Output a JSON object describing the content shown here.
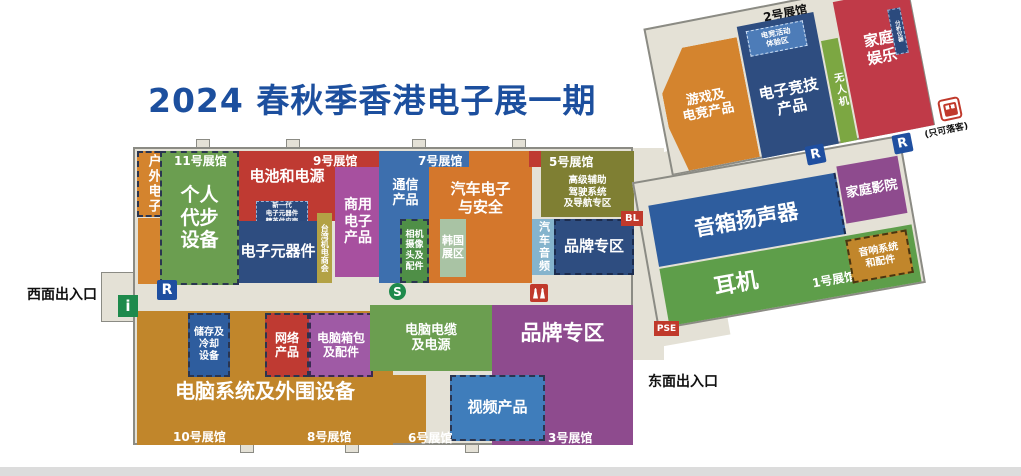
{
  "title": "2024 春秋季香港电子展一期",
  "colors": {
    "title_blue": "#1c4f9e",
    "floor_beige": "#e4e1d6",
    "orange": "#d4842e",
    "tan": "#c1862b",
    "red": "#bf3a32",
    "crimson": "#c03a48",
    "green": "#6b9e50",
    "dark_green": "#4f8f47",
    "sage": "#a9c3a4",
    "navy": "#2e4d80",
    "blue": "#3d6fae",
    "light_blue": "#85b4cd",
    "steel_blue": "#3f7dbb",
    "magenta": "#a7509f",
    "purple": "#8e4b8e",
    "olive": "#7f7f33",
    "gold": "#b3a245",
    "icon_green": "#1e8a4c",
    "icon_blue": "#1f4fa0",
    "icon_red": "#c0392b"
  },
  "entrances": {
    "west": "西面出入口",
    "east": "东面出入口",
    "dropoff": "(只可落客)"
  },
  "hall_labels": {
    "h11": "11号展馆",
    "h9": "9号展馆",
    "h7": "7号展馆",
    "h5": "5号展馆",
    "h2": "2号展馆",
    "h10": "10号展馆",
    "h8": "8号展馆",
    "h6": "6号展馆",
    "h3": "3号展馆",
    "h1": "1号展馆"
  },
  "zones": {
    "outdoor": {
      "label": "户外电子"
    },
    "personal_mobility": {
      "label": "个人\n代步\n设备"
    },
    "battery": {
      "label": "电池和电源"
    },
    "nextgen": {
      "label": "新一代\n电子元器件\n精英供应商"
    },
    "components": {
      "label": "电子元器件"
    },
    "taiwan": {
      "label": "台湾机电商会"
    },
    "commercial": {
      "label": "商用\n电子\n产品"
    },
    "communication": {
      "label": "通信\n产品"
    },
    "camera": {
      "label": "相机\n摄像\n头及\n配件"
    },
    "automotive": {
      "label": "汽车电子\n与安全"
    },
    "korea": {
      "label": "韩国展区"
    },
    "adas": {
      "label": "高级辅助\n驾驶系统\n及导航专区"
    },
    "car_audio": {
      "label": "汽车音频"
    },
    "brand_top": {
      "label": "品牌专区"
    },
    "storage": {
      "label": "储存及\n冷却\n设备"
    },
    "network": {
      "label": "网络\n产品"
    },
    "bags": {
      "label": "电脑箱包\n及配件"
    },
    "cables": {
      "label": "电脑电缆\n及电源"
    },
    "systems": {
      "label": "电脑系统及外围设备"
    },
    "video": {
      "label": "视频产品"
    },
    "brand_bottom": {
      "label": "品牌专区"
    },
    "gaming": {
      "label": "游戏及\n电竞产品"
    },
    "esports": {
      "label": "电子竞技\n产品"
    },
    "esports_exp": {
      "label": "电竞活动\n体验区"
    },
    "drones": {
      "label": "无人机"
    },
    "home_ent": {
      "label": "家庭\n娱乐"
    },
    "analysis": {
      "label": "分析仪器"
    },
    "speakers": {
      "label": "音箱扬声器"
    },
    "home_cinema": {
      "label": "家庭影院"
    },
    "headphones": {
      "label": "耳机"
    },
    "audio_acc": {
      "label": "音响系统\n和配件"
    }
  },
  "icons": {
    "info": "i",
    "restroom": "R",
    "service": "S",
    "bl": "BL",
    "pse": "PSE"
  }
}
